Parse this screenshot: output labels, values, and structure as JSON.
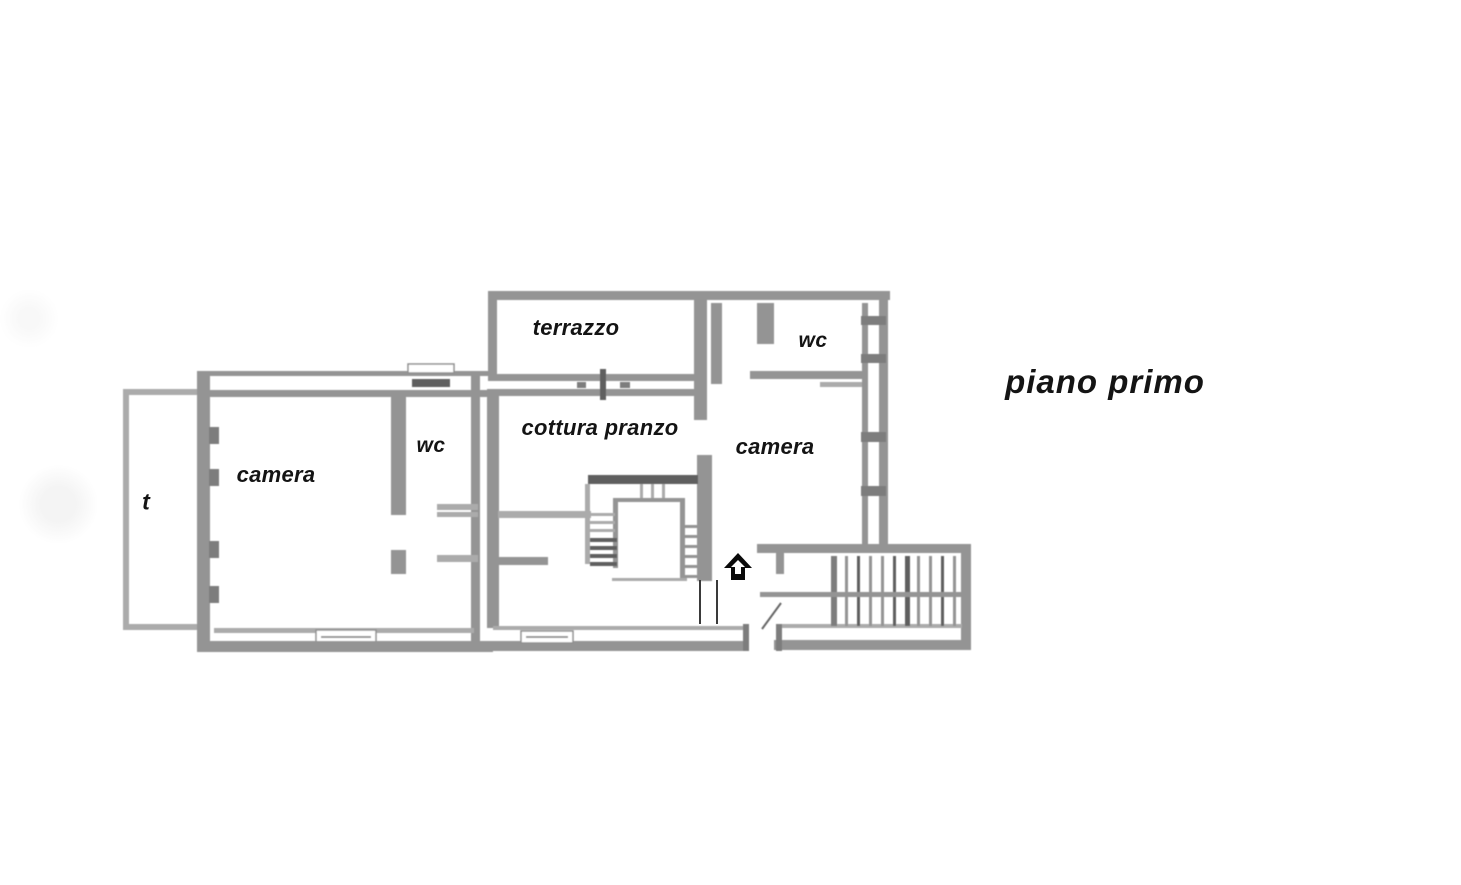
{
  "plan": {
    "title": "piano primo"
  },
  "rooms": {
    "terrazzo": {
      "label": "terrazzo"
    },
    "wc_top": {
      "label": "wc"
    },
    "cottura_pranzo": {
      "label": "cottura pranzo"
    },
    "camera_right": {
      "label": "camera"
    },
    "camera_left": {
      "label": "camera"
    },
    "wc_left": {
      "label": "wc"
    },
    "t_room": {
      "label": "t"
    }
  },
  "icons": {
    "stair_direction": "up-arrow"
  },
  "colors": {
    "background": "#ffffff",
    "wall": "#949494",
    "wall_dark": "#5f5f5f",
    "wall_light": "#ababab",
    "text": "#141414",
    "arrow": "#0a0a0a"
  }
}
